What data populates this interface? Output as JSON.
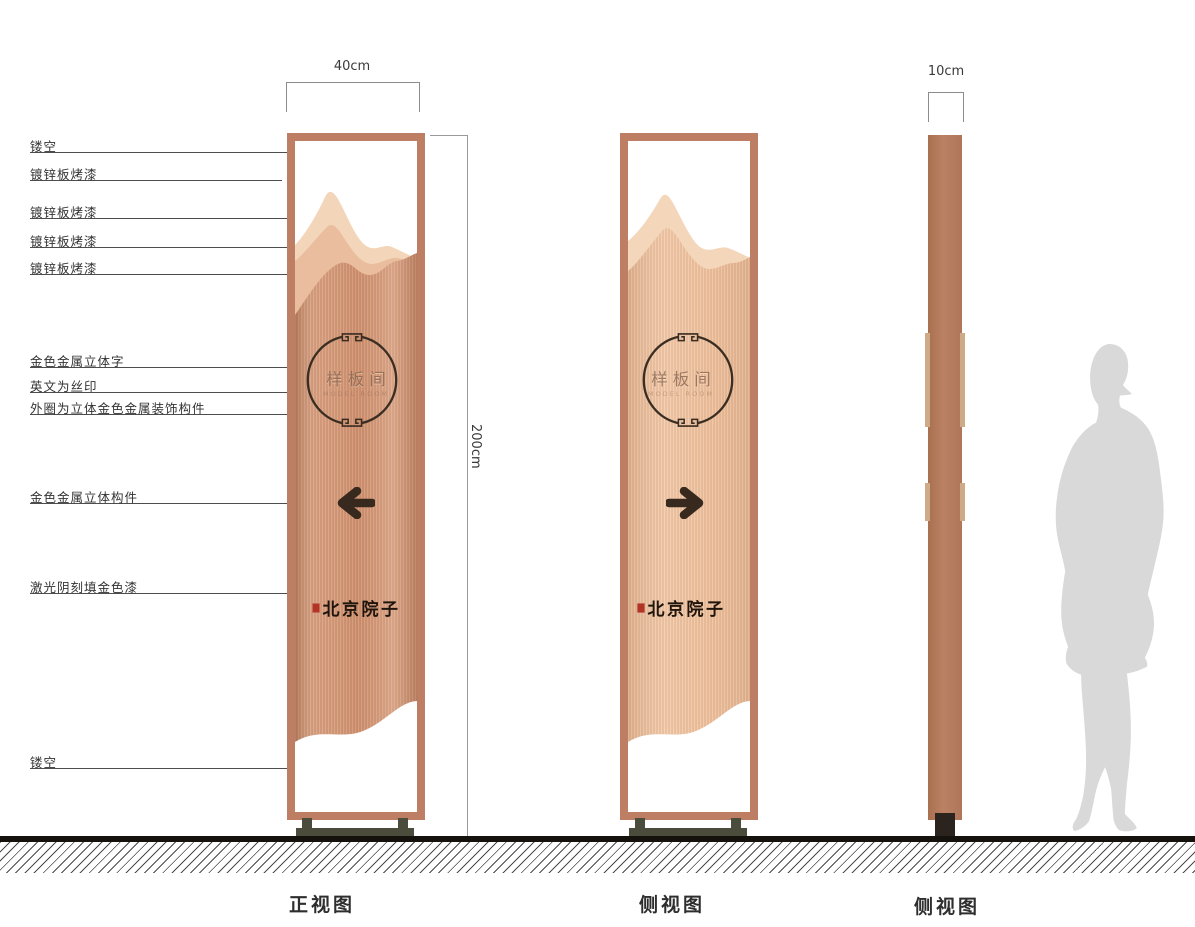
{
  "dimensions": {
    "front_width_label": "40cm",
    "height_label": "200cm",
    "profile_width_label": "10cm"
  },
  "annotations": [
    {
      "label": "镂空",
      "y": 152,
      "x2": 305
    },
    {
      "label": "镀锌板烤漆",
      "y": 180,
      "x2": 282
    },
    {
      "label": "镀锌板烤漆",
      "y": 218,
      "x2": 322
    },
    {
      "label": "镀锌板烤漆",
      "y": 247,
      "x2": 291
    },
    {
      "label": "镀锌板烤漆",
      "y": 274,
      "x2": 293
    },
    {
      "label": "金色金属立体字",
      "y": 367,
      "x2": 320
    },
    {
      "label": "英文为丝印",
      "y": 392,
      "x2": 332
    },
    {
      "label": "外圈为立体金色金属装饰构件",
      "y": 414,
      "x2": 311
    },
    {
      "label": "金色金属立体构件",
      "y": 503,
      "x2": 335
    },
    {
      "label": "激光阴刻填金色漆",
      "y": 593,
      "x2": 287
    },
    {
      "label": "镂空",
      "y": 768,
      "x2": 302
    }
  ],
  "sign": {
    "circle_text": "样板间",
    "circle_subtext": "MODEL ROOM",
    "brand_text": "北京院子"
  },
  "views": {
    "front": {
      "caption": "正视图"
    },
    "side": {
      "caption": "侧视图"
    },
    "profile": {
      "caption": "侧视图"
    }
  },
  "colors": {
    "frame": "#bd7e63",
    "panel_front": "#cd9170",
    "panel_side": "#e9bb99",
    "mountain_light": "#f3d5ba",
    "mountain_mid": "#e9bd9d",
    "profile_bar": "#b57a5e",
    "profile_trim": "#cdab89",
    "base": "#4c4c3c",
    "ground": "#15120e",
    "figure": "#d9d9d9",
    "seal_red": "#b23524",
    "ink": "#3a2d22"
  }
}
